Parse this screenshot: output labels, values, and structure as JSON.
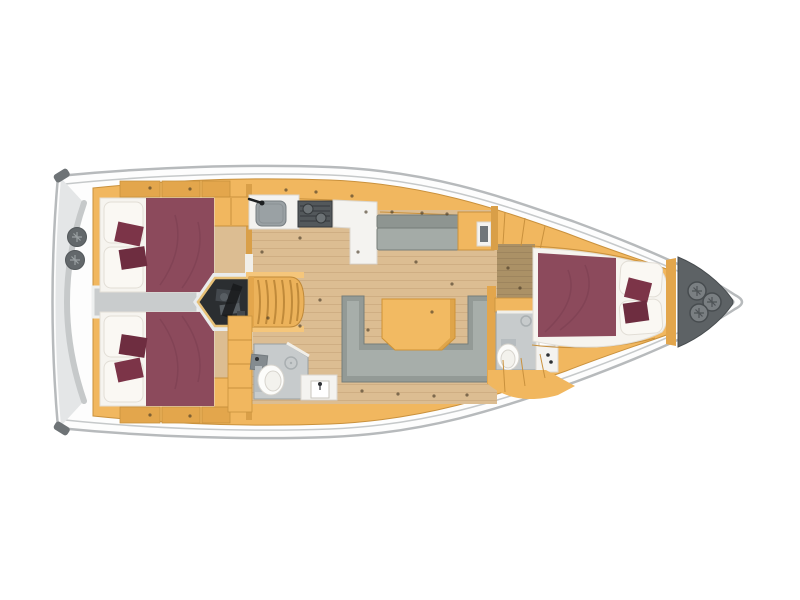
{
  "diagram": {
    "type": "yacht-interior-deck-plan",
    "orientation": "bow-right",
    "regions": [
      "stern-platform",
      "aft-cabin-port",
      "aft-cabin-starboard",
      "engine-compartment",
      "companionway-stairs",
      "galley",
      "salon",
      "aft-head",
      "forward-head",
      "forward-cabin",
      "anchor-locker"
    ]
  },
  "colors": {
    "hull_fill": "#fdfdfd",
    "hull_stroke": "#b7babc",
    "deck_line": "#c6c9ca",
    "stern_shade": "#e4e6e7",
    "stern_cap": "#6e7376",
    "stern_circle": "#63686b",
    "stern_circle_mark": "#9aa0a2",
    "cabinetry": "#f1b75f",
    "cabinetry_line": "#c9913d",
    "cabinetry_dark": "#e3a64c",
    "wall": "#d99f48",
    "wood": "#dcbd92",
    "wood_line": "#c9a87b",
    "wood_dark": "#ab9166",
    "wood_dark_line": "#99805b",
    "walkway": "#c9cccd",
    "walkway_edge": "#eef0f0",
    "bed_white": "#f6f4ef",
    "bed_shadow": "#e2ded6",
    "burgundy": "#8c4a5c",
    "crease": "#7e4052",
    "pillow_white": "#faf8f3",
    "pillow_accent_1": "#7c3448",
    "pillow_accent_2": "#6e2d40",
    "sofa": "#939a96",
    "sofa_light": "#a7aeaa",
    "sofa_stroke": "#767d79",
    "bench_back": "#8e9591",
    "bench_seat": "#a4aba7",
    "table": "#f2ba62",
    "table_edge": "#cf9336",
    "counter": "#f4f3f0",
    "counter_stroke": "#dbd7d0",
    "sink": "#9aa1a4",
    "sink_stroke": "#767d81",
    "stove": "#53585b",
    "stove_detail": "#35393c",
    "burner": "#6c7275",
    "engine_rim": "#e9ebec",
    "engine": "#2b2e31",
    "engine_border": "#e7c077",
    "engine_part1": "#44494e",
    "engine_part2": "#17191b",
    "engine_part3": "#585e63",
    "stairs": "#ecb25a",
    "stairs_line": "#c08a3a",
    "stairs_rail": "#f5c67b",
    "shower": "#c7cbcc",
    "shower_stroke": "#9aa0a2",
    "toilet": "#fcfcfa",
    "toilet_stroke": "#d7d4cd",
    "toilet_tank": "#b6bcbf",
    "drain": "#a9afb1",
    "door": "#f1efe9",
    "locker": "#5d6265",
    "locker_stroke": "#474c4f",
    "locker_circle": "#7a7f82",
    "locker_mark": "#4e5356",
    "fitting": "#4a3c28"
  }
}
